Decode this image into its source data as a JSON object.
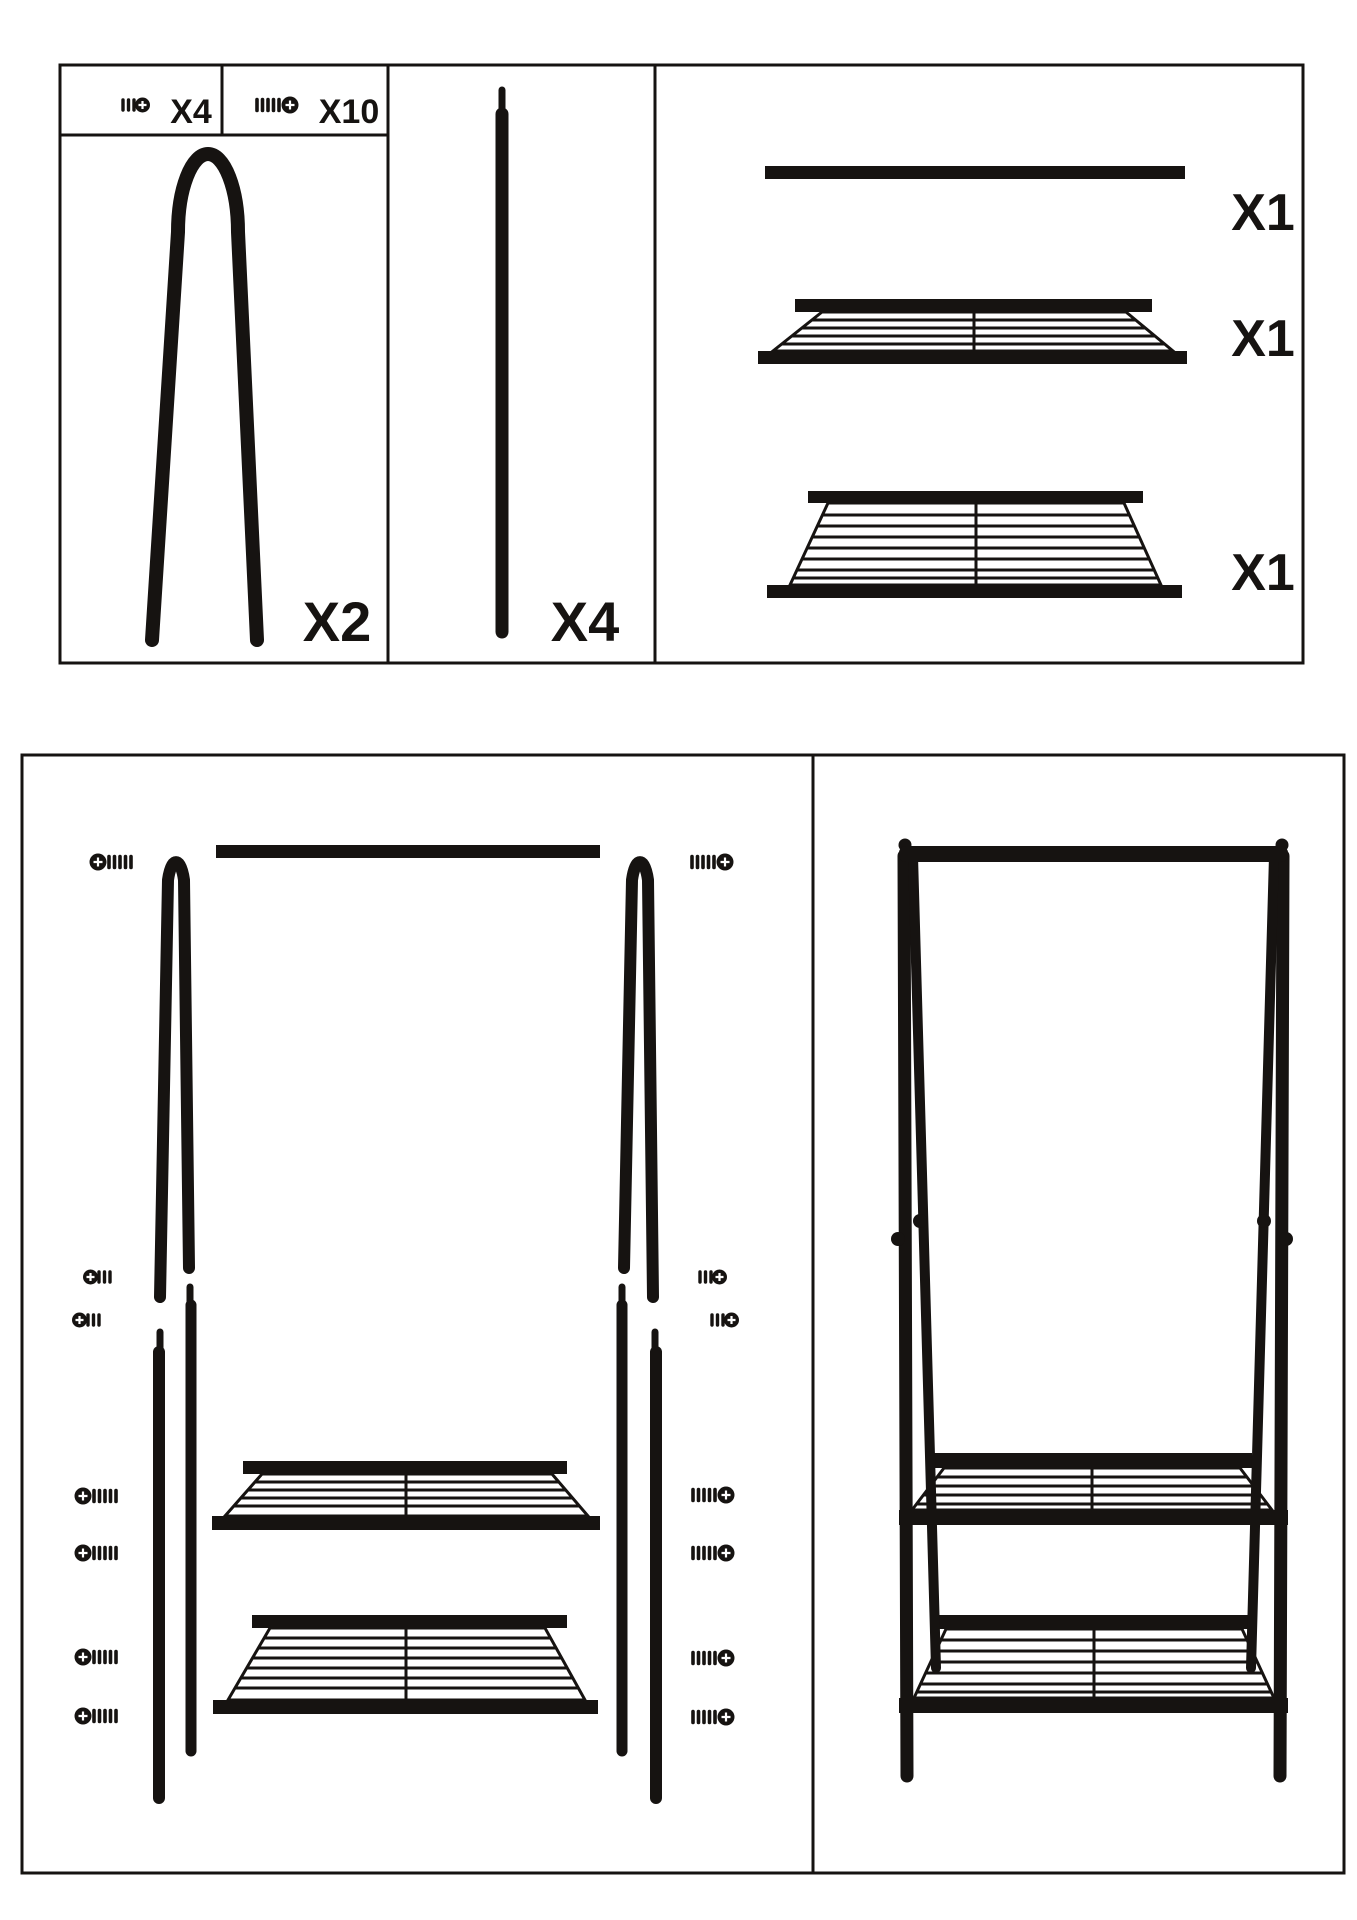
{
  "colors": {
    "ink": "#161311",
    "background": "#ffffff"
  },
  "parts_box": {
    "screw_short": {
      "qty_label": "X4",
      "icon": "phillips-screw-short-icon"
    },
    "screw_long": {
      "qty_label": "X10",
      "icon": "phillips-screw-long-icon"
    },
    "a_frame_leg": {
      "qty_label": "X2"
    },
    "pole": {
      "qty_label": "X4"
    },
    "hanging_rod": {
      "qty_label": "X1"
    },
    "shelf_upper": {
      "qty_label": "X1"
    },
    "shelf_lower": {
      "qty_label": "X1"
    }
  }
}
